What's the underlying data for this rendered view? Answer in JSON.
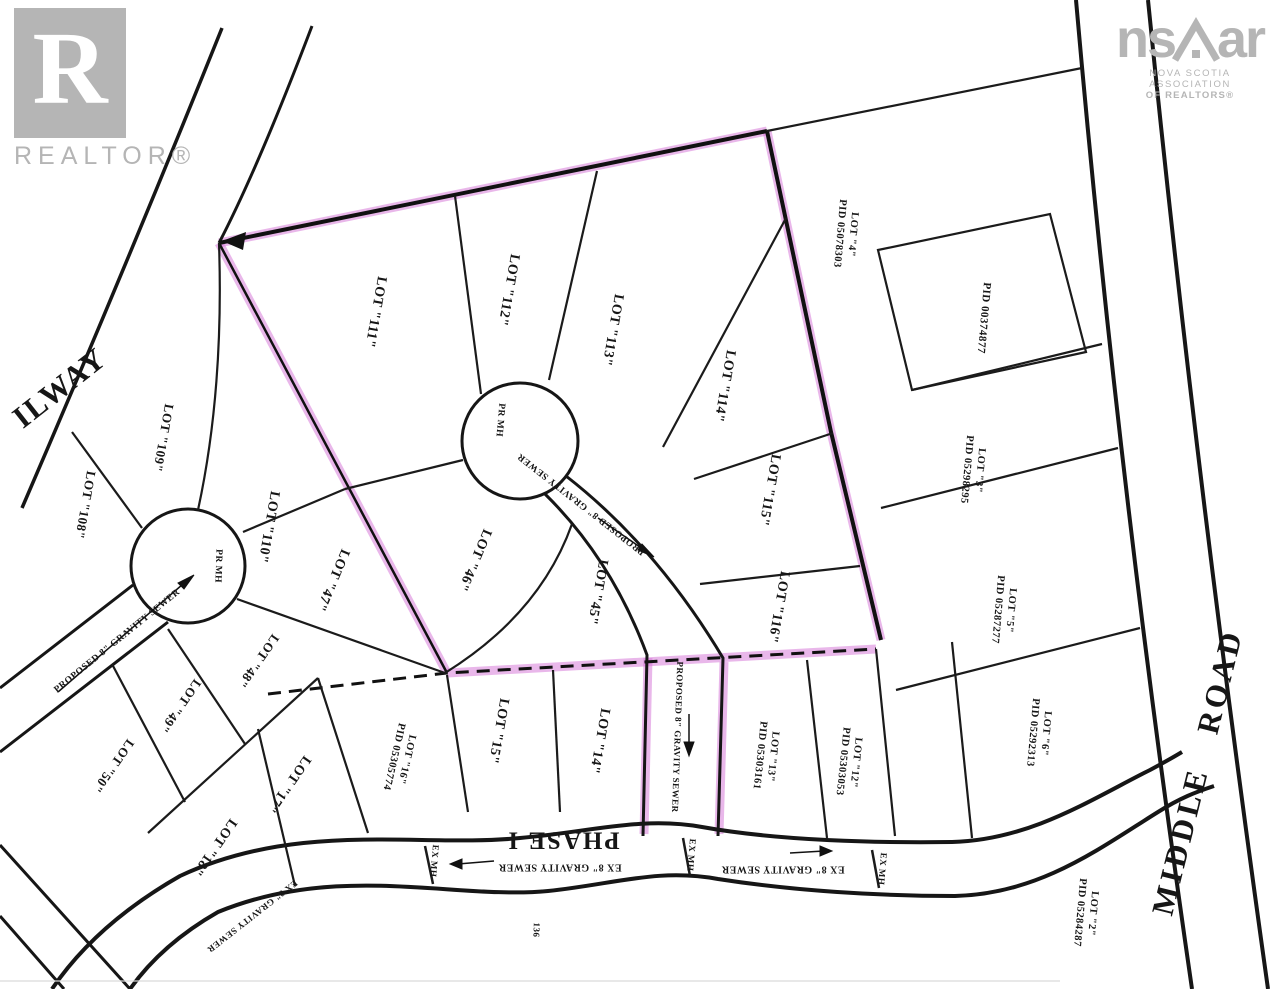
{
  "branding": {
    "realtor": {
      "letter": "R",
      "label": "REALTOR®"
    },
    "nsar": {
      "left": "ns",
      "right": "ar",
      "assoc1": "NOVA SCOTIA ASSOCIATION",
      "assoc2": "OF REALTORS®"
    }
  },
  "map": {
    "colors": {
      "highlight": "#d36fd6",
      "line": "#161616",
      "logo": "#b5b5b5"
    },
    "labels": [
      {
        "name": "lot-108-label",
        "text": "LOT \"108\"",
        "x": 85,
        "y": 505,
        "rot": 100,
        "size": 13
      },
      {
        "name": "lot-109-label",
        "text": "LOT \"109\"",
        "x": 163,
        "y": 438,
        "rot": 100,
        "size": 13
      },
      {
        "name": "lot-110-label",
        "text": "LOT \"110\"",
        "x": 268,
        "y": 527,
        "rot": 100,
        "size": 14
      },
      {
        "name": "lot-111-label",
        "text": "LOT \"111\"",
        "x": 375,
        "y": 312,
        "rot": 100,
        "size": 14
      },
      {
        "name": "lot-112-label",
        "text": "LOT \"112\"",
        "x": 508,
        "y": 290,
        "rot": 100,
        "size": 14
      },
      {
        "name": "lot-113-label",
        "text": "LOT \"113\"",
        "x": 612,
        "y": 330,
        "rot": 100,
        "size": 14
      },
      {
        "name": "lot-114-label",
        "text": "LOT \"114\"",
        "x": 724,
        "y": 386,
        "rot": 100,
        "size": 14
      },
      {
        "name": "lot-115-label",
        "text": "LOT \"115\"",
        "x": 769,
        "y": 490,
        "rot": 100,
        "size": 14
      },
      {
        "name": "lot-116-label",
        "text": "LOT \"116\"",
        "x": 778,
        "y": 607,
        "rot": 100,
        "size": 14
      },
      {
        "name": "lot-46-label",
        "text": "LOT \"46\"",
        "x": 474,
        "y": 560,
        "rot": 113,
        "size": 14
      },
      {
        "name": "lot-47-label",
        "text": "LOT \"47\"",
        "x": 332,
        "y": 580,
        "rot": 113,
        "size": 14
      },
      {
        "name": "lot-45-label",
        "text": "LOT \"45\"",
        "x": 597,
        "y": 592,
        "rot": 100,
        "size": 14
      },
      {
        "name": "lot-48-label",
        "text": "LOT \"48\"",
        "x": 258,
        "y": 661,
        "rot": 125,
        "size": 13
      },
      {
        "name": "lot-49-label",
        "text": "LOT \"49\"",
        "x": 180,
        "y": 706,
        "rot": 125,
        "size": 13
      },
      {
        "name": "lot-50-label",
        "text": "LOT \"50\"",
        "x": 113,
        "y": 766,
        "rot": 125,
        "size": 13
      },
      {
        "name": "lot-17-label",
        "text": "LOT \"17\"",
        "x": 288,
        "y": 784,
        "rot": 125,
        "size": 14
      },
      {
        "name": "lot-18-label",
        "text": "LOT \"18\"",
        "x": 214,
        "y": 847,
        "rot": 125,
        "size": 14
      },
      {
        "name": "lot-16-label",
        "text": "LOT \"16\"\nPID 05305774",
        "x": 400,
        "y": 758,
        "rot": 103,
        "size": 10.5
      },
      {
        "name": "lot-15-label",
        "text": "LOT \"15\"",
        "x": 498,
        "y": 731,
        "rot": 100,
        "size": 14
      },
      {
        "name": "lot-14-label",
        "text": "LOT \"14\"",
        "x": 599,
        "y": 741,
        "rot": 100,
        "size": 14
      },
      {
        "name": "lot-13-label",
        "text": "LOT \"13\"\nPID 05303161",
        "x": 766,
        "y": 756,
        "rot": 96,
        "size": 10.5
      },
      {
        "name": "lot-12-label",
        "text": "LOT \"12\"\nPID 05303053",
        "x": 849,
        "y": 762,
        "rot": 96,
        "size": 10.5
      },
      {
        "name": "lot-4-label",
        "text": "LOT \"4\"\nPID 05078303",
        "x": 846,
        "y": 234,
        "rot": 95,
        "size": 10.5
      },
      {
        "name": "pid-00374877-label",
        "text": "PID 00374877",
        "x": 983,
        "y": 318,
        "rot": 95,
        "size": 11
      },
      {
        "name": "lot-3-label",
        "text": "LOT \"3\"\nPID 05298295",
        "x": 973,
        "y": 470,
        "rot": 95,
        "size": 10.5
      },
      {
        "name": "lot-5-label",
        "text": "LOT \"5\"\nPID 05287277",
        "x": 1004,
        "y": 610,
        "rot": 95,
        "size": 10.5
      },
      {
        "name": "lot-6-label",
        "text": "LOT \"6\"\nPID 05292313",
        "x": 1039,
        "y": 733,
        "rot": 95,
        "size": 10.5
      },
      {
        "name": "lot-2-label",
        "text": "LOT \"2\"\nPID 05284287",
        "x": 1086,
        "y": 913,
        "rot": 95,
        "size": 10.5
      },
      {
        "name": "railway-label",
        "text": "ILWAY",
        "x": 60,
        "y": 388,
        "rot": -38,
        "size": 31,
        "ls": 2
      },
      {
        "name": "middle-road-label",
        "text": "MIDDLE   ROAD",
        "x": 1198,
        "y": 772,
        "rot": -76,
        "size": 31,
        "ls": 4
      },
      {
        "name": "phase-1-label",
        "text": "PHASE I",
        "x": 563,
        "y": 840,
        "rot": 180,
        "size": 25,
        "ls": 2
      },
      {
        "name": "ex-gravity-sewer-left-label",
        "text": "EX 8\" GRAVITY SEWER",
        "x": 560,
        "y": 866,
        "rot": 180,
        "size": 10
      },
      {
        "name": "ex-gravity-sewer-right-label",
        "text": "EX 8\" GRAVITY SEWER",
        "x": 783,
        "y": 868,
        "rot": 180,
        "size": 10
      },
      {
        "name": "proposed-sewer-west-label",
        "text": "PROPOSED 8\" GRAVITY SEWER",
        "x": 118,
        "y": 642,
        "rot": -39,
        "size": 9.5
      },
      {
        "name": "proposed-sewer-road2-label",
        "text": "PROPOSED 8\" GRAVITY SEWER",
        "x": 582,
        "y": 503,
        "rot": 218,
        "size": 9.5
      },
      {
        "name": "proposed-sewer-strip-label",
        "text": "PROPOSED 8\" GRAVITY SEWER",
        "x": 677,
        "y": 737,
        "rot": 92,
        "size": 9
      },
      {
        "name": "pr-mh-west-label",
        "text": "PR MH",
        "x": 217,
        "y": 566,
        "rot": 92,
        "size": 9.5
      },
      {
        "name": "pr-mh-center-label",
        "text": "PR MH",
        "x": 499,
        "y": 420,
        "rot": 95,
        "size": 9.5
      },
      {
        "name": "ex-mh-1-label",
        "text": "EX MH",
        "x": 434,
        "y": 861,
        "rot": 95,
        "size": 9
      },
      {
        "name": "ex-mh-2-label",
        "text": "EX MH",
        "x": 691,
        "y": 855,
        "rot": 95,
        "size": 9
      },
      {
        "name": "ex-mh-3-label",
        "text": "EX MH",
        "x": 882,
        "y": 869,
        "rot": 95,
        "size": 9
      },
      {
        "name": "ex-sewer-corner-label",
        "text": "EX 8\" GRAVITY SEWER",
        "x": 252,
        "y": 916,
        "rot": 142,
        "size": 9
      },
      {
        "name": "artifact-text",
        "text": "136",
        "x": 536,
        "y": 930,
        "rot": 92,
        "size": 9
      }
    ]
  }
}
